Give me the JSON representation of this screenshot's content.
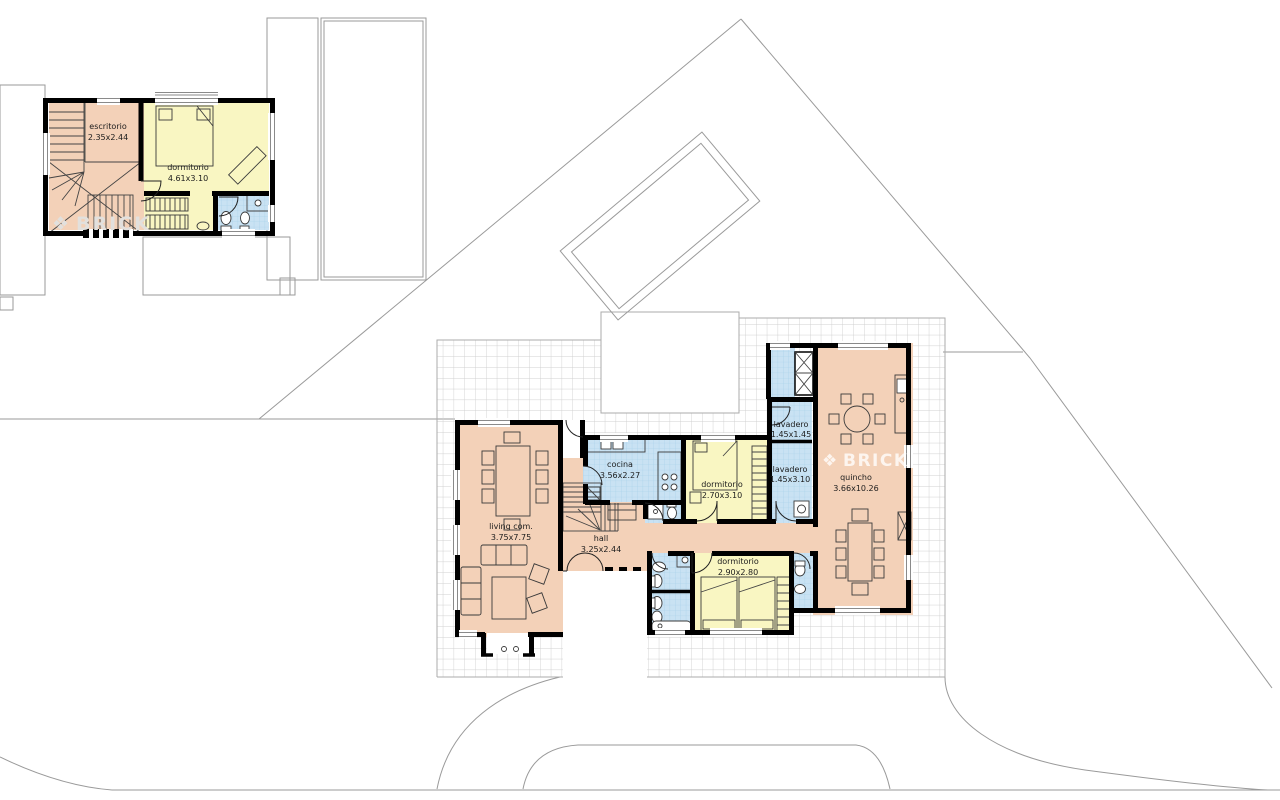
{
  "watermark": {
    "logo_glyph": "❖",
    "text": "BRICK"
  },
  "palette": {
    "room_social": "#f3d1b8",
    "room_bedroom": "#f9f6c2",
    "room_wet": "#c9e2f3",
    "wall": "#000000",
    "grid_line": "#d0d0d0",
    "wet_tile_line": "#a5cfe8",
    "site_line": "#9a9a9a",
    "label_text": "#1c1c1c",
    "watermark_main": "rgba(255,255,255,0.78)",
    "watermark_upper": "#e2e0dd"
  },
  "upper_floor": {
    "rooms": [
      {
        "name": "escritorio",
        "dims": "2.35x2.44"
      },
      {
        "name": "dormitorio",
        "dims": "4.61x3.10"
      }
    ]
  },
  "main_floor": {
    "rooms": [
      {
        "name": "living com.",
        "dims": "3.75x7.75"
      },
      {
        "name": "cocina",
        "dims": "3.56x2.27"
      },
      {
        "name": "hall",
        "dims": "3.25x2.44"
      },
      {
        "name": "dormitorio",
        "dims": "2.70x3.10"
      },
      {
        "name": "lavadero",
        "dims": "1.45x1.45"
      },
      {
        "name": "lavadero",
        "dims": "1.45x3.10"
      },
      {
        "name": "quincho",
        "dims": "3.66x10.26"
      },
      {
        "name": "dormitorio",
        "dims": "2.90x2.80"
      }
    ]
  }
}
